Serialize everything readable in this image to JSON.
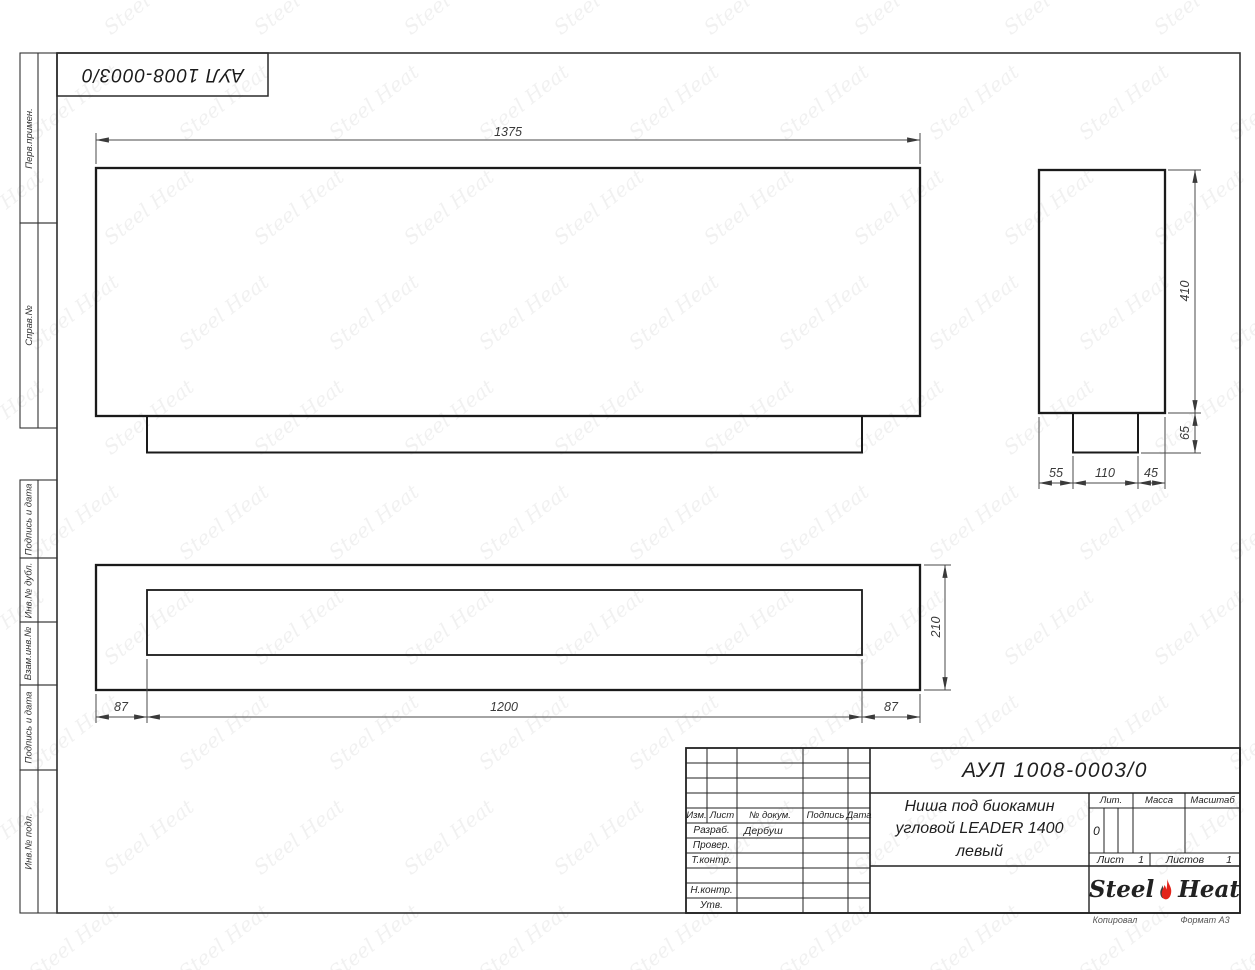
{
  "sheet": {
    "doc_number_top": "АУЛ 1008-0003/0",
    "footer": {
      "copied_label": "Копировал",
      "format_label": "Формат А3"
    },
    "watermark": {
      "text": "Steel Heat"
    }
  },
  "side_strip": {
    "cells": [
      {
        "label": "Перв.примен."
      },
      {
        "label": "Справ.№"
      },
      {
        "label": "Подпись и дата"
      },
      {
        "label": "Инв.№ дубл."
      },
      {
        "label": "Взам.инв.№"
      },
      {
        "label": "Подпись и дата"
      },
      {
        "label": "Инв.№ подл."
      }
    ]
  },
  "views": {
    "front": {
      "width_dim": "1375"
    },
    "side": {
      "height_dim": "410",
      "foot_height_dim": "65",
      "bottom_dims": [
        "55",
        "110",
        "45"
      ]
    },
    "top": {
      "depth_dim": "210",
      "bottom_dims": [
        "87",
        "1200",
        "87"
      ]
    }
  },
  "title_block": {
    "doc_number": "АУЛ 1008-0003/0",
    "name_line1": "Ниша под биокамин",
    "name_line2": "угловой LEADER 1400",
    "name_line3": "левый",
    "header_cols": [
      "Изм.",
      "Лист",
      "№ докум.",
      "Подпись",
      "Дата"
    ],
    "rows": [
      {
        "label": "Разраб.",
        "value": "Дербуш"
      },
      {
        "label": "Провер.",
        "value": ""
      },
      {
        "label": "Т.контр.",
        "value": ""
      },
      {
        "label": "Н.контр.",
        "value": ""
      },
      {
        "label": "Утв.",
        "value": ""
      }
    ],
    "lit": {
      "label": "Лит.",
      "value": "0"
    },
    "massa_label": "Масса",
    "masshtab_label": "Масштаб",
    "list": {
      "label": "Лист",
      "value": "1"
    },
    "listov": {
      "label": "Листов",
      "value": "1"
    },
    "logo": {
      "word1": "Steel",
      "word2": "Heat",
      "flame_color": "#e3241b"
    }
  }
}
